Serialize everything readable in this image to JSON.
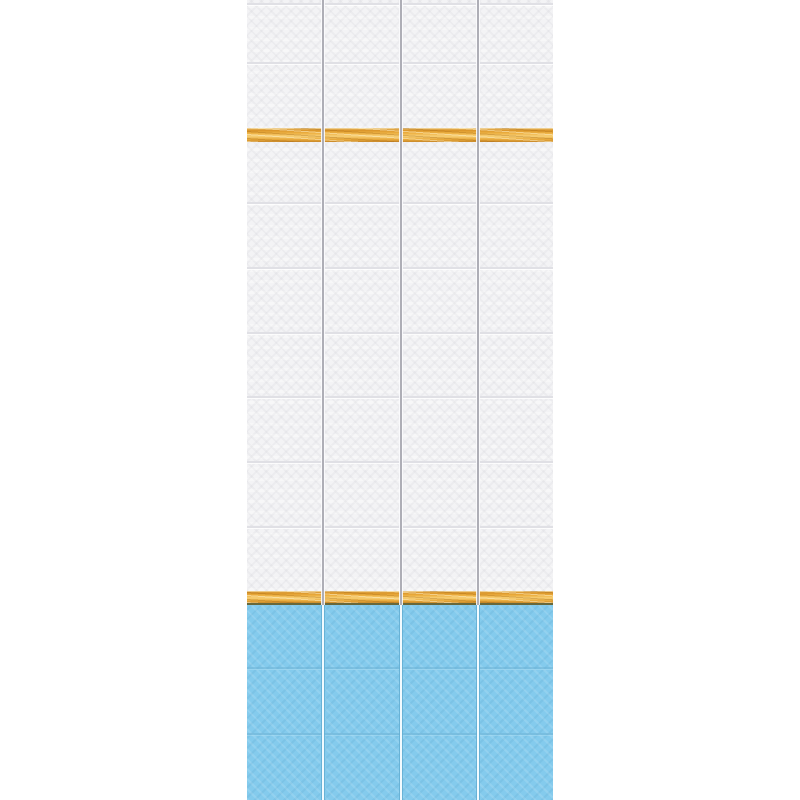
{
  "scene": {
    "type": "product-photo",
    "subject": "Decorative PVC wall panels with embossed tile pattern: white tile field, two golden wood-grain accent stripes, sky-blue tile band at bottom",
    "background_color": "#ffffff",
    "canvas_width": 800,
    "canvas_height": 800
  },
  "strip": {
    "left": 247,
    "top": 0,
    "width": 306,
    "height": 800,
    "panel_count": 4,
    "joint_x": [
      75,
      153,
      230
    ],
    "joint_color_upper": "#aeaeb6",
    "joint_color_lower_core": "#f2fbff",
    "joint_color_lower_edge": "#63aed2"
  },
  "white_section": {
    "tile_color": "#f3f3f5",
    "seam_color": "#e0e0e5",
    "seam_y": [
      3,
      62,
      202,
      267,
      332,
      396,
      461,
      526
    ]
  },
  "gold_stripes": [
    {
      "top": 128,
      "height": 14,
      "dark_bottom": false
    },
    {
      "top": 591,
      "height": 12,
      "dark_bottom": true
    }
  ],
  "gold_colors": {
    "base": "#eaaa3c",
    "highlight": "#f7d077",
    "shadow": "#c8882a",
    "olive_edge": "#68683a"
  },
  "blue_section": {
    "top": 605,
    "height": 195,
    "tile_color": "#84cbed",
    "seam_dark": "#6fb4d6",
    "seam_light": "#a9ddf3",
    "seam_y": [
      667,
      733
    ]
  }
}
